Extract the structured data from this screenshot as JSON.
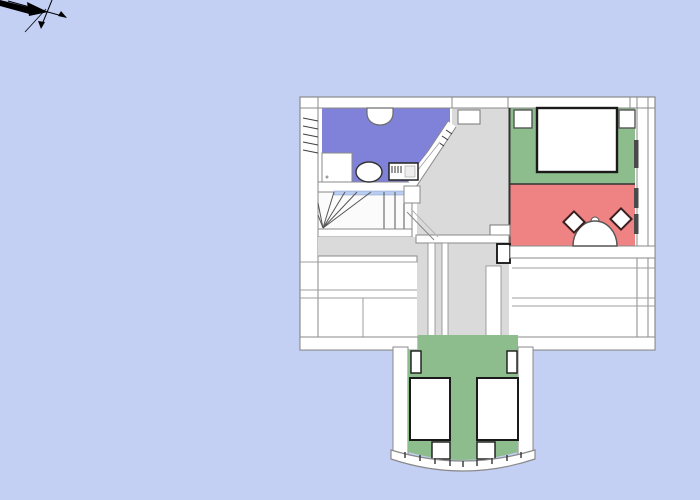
{
  "app": {
    "kind": "floor-plan-viewport"
  },
  "canvas": {
    "width": 700,
    "height": 500,
    "background": "#c3d0f4"
  },
  "palette": {
    "wall_fill": "#ffffff",
    "wall_edge": "#8a8a8a",
    "soft_line": "#9d9d9d",
    "dark_line": "#1a1a1a",
    "hall_floor": "#dadada",
    "bathroom_floor": "#7f82d8",
    "bedroom_green_floor": "#8dbd8d",
    "red_room_floor": "#ef8383",
    "kids_room_floor": "#8dbd8d",
    "stair_accent": "#b9cdf2",
    "window_mark": "#4a4a4a",
    "axes_color": "#000000"
  },
  "rooms": [
    {
      "id": "bathroom",
      "floor_color": "#7f82d8"
    },
    {
      "id": "bedroom-green",
      "floor_color": "#8dbd8d"
    },
    {
      "id": "red-room",
      "floor_color": "#ef8383"
    },
    {
      "id": "hallway",
      "floor_color": "#dadada"
    },
    {
      "id": "kids-room",
      "floor_color": "#8dbd8d"
    }
  ]
}
